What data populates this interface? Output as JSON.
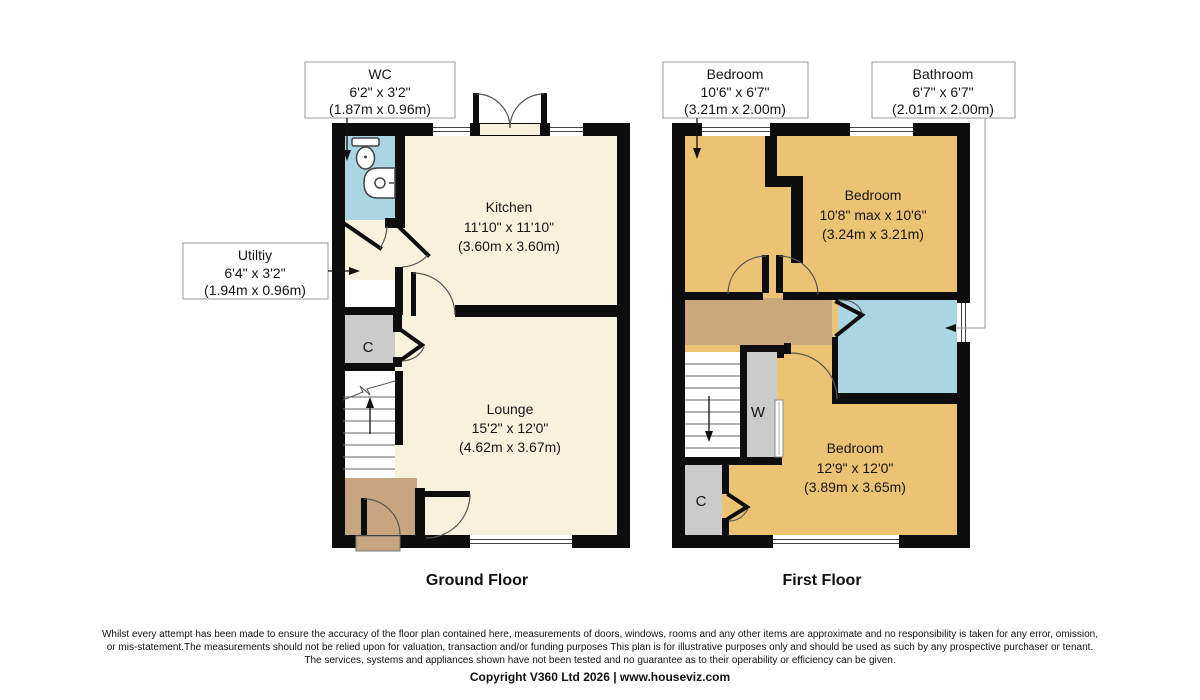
{
  "ground": {
    "title": "Ground Floor",
    "kitchen": {
      "name": "Kitchen",
      "imperial": "11'10\" x 11'10\"",
      "metric": "(3.60m x 3.60m)"
    },
    "lounge": {
      "name": "Lounge",
      "imperial": "15'2\" x 12'0\"",
      "metric": "(4.62m x 3.67m)"
    },
    "cupboard": "C",
    "wc": {
      "name": "WC",
      "imperial": "6'2\" x 3'2\"",
      "metric": "(1.87m x 0.96m)"
    },
    "utility": {
      "name": "Utiltiy",
      "imperial": "6'4\" x 3'2\"",
      "metric": "(1.94m x 0.96m)"
    }
  },
  "first": {
    "title": "First Floor",
    "bedroom_rear": {
      "name": "Bedroom",
      "imperial": "10'8\" max x 10'6\"",
      "metric": "(3.24m x 3.21m)"
    },
    "bedroom_front": {
      "name": "Bedroom",
      "imperial": "12'9\" x 12'0\"",
      "metric": "(3.89m x 3.65m)"
    },
    "bedroom_small": {
      "name": "Bedroom",
      "imperial": "10'6\" x 6'7\"",
      "metric": "(3.21m x 2.00m)"
    },
    "bathroom": {
      "name": "Bathroom",
      "imperial": "6'7\" x 6'7\"",
      "metric": "(2.01m x 2.00m)"
    },
    "wardrobe": "W",
    "cupboard": "C"
  },
  "footer": {
    "disclaimer": [
      "Whilst every attempt has been made to ensure the accuracy of the floor plan contained here, measurements of doors, windows, rooms and any other items are approximate and no responsibility is taken for any error, omission,",
      "or mis-statement.The measurements should not be relied upon for valuation, transaction and/or funding purposes This plan is for illustrative purposes only and should be used as such by any prospective purchaser or tenant.",
      "The services, systems and appliances shown have not been tested and no guarantee as to their operability or efficiency can be given."
    ],
    "copyright": "Copyright V360 Ltd 2026 | www.houseviz.com"
  },
  "colors": {
    "wall": "#0d0d0d",
    "room_cream": "#f8f1dc",
    "room_gold": "#ebc372",
    "landing_tan": "#c9a87c",
    "hall_tan": "#c7a580",
    "wet_blue": "#aad5e3",
    "closet_gray": "#cbcbcb"
  }
}
